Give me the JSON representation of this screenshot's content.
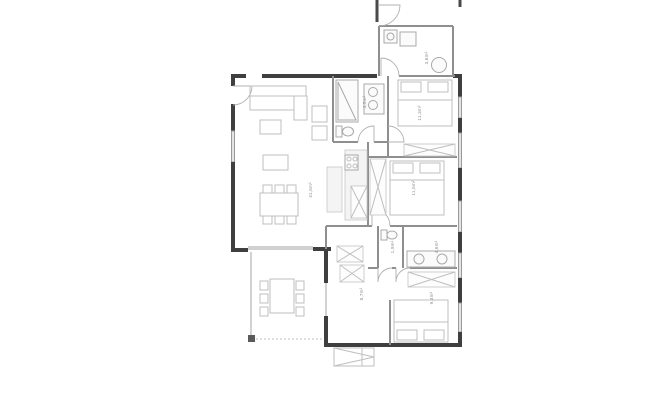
{
  "document": {
    "kind": "apartment-floor-plan",
    "orientation": "plan-view"
  },
  "colors": {
    "background": "#ffffff",
    "wall_dark": "#3f3f3f",
    "wall_interior": "#8f8f8f",
    "furniture_line": "#c4c4c4",
    "window_fill": "#e3e3e3",
    "label_text": "#8e8e8e"
  },
  "rooms": {
    "living": {
      "name": "living-dining-kitchen",
      "area_label": "41,5m²"
    },
    "bath1": {
      "name": "bathroom-top",
      "area_label": "4,5m²"
    },
    "bed1": {
      "name": "bedroom-top-right",
      "area_label": "11,3m²"
    },
    "annex": {
      "name": "entrance-annex",
      "area_label": "3,6m²"
    },
    "bed2": {
      "name": "bedroom-middle-right",
      "area_label": "11,5m²"
    },
    "wc": {
      "name": "wc",
      "area_label": "1,9m²"
    },
    "bath2": {
      "name": "bathroom-bottom",
      "area_label": "4,6m²"
    },
    "hall": {
      "name": "hallway",
      "area_label": "8,7m²"
    },
    "bed3": {
      "name": "bedroom-bottom",
      "area_label": "9,4m²"
    }
  }
}
